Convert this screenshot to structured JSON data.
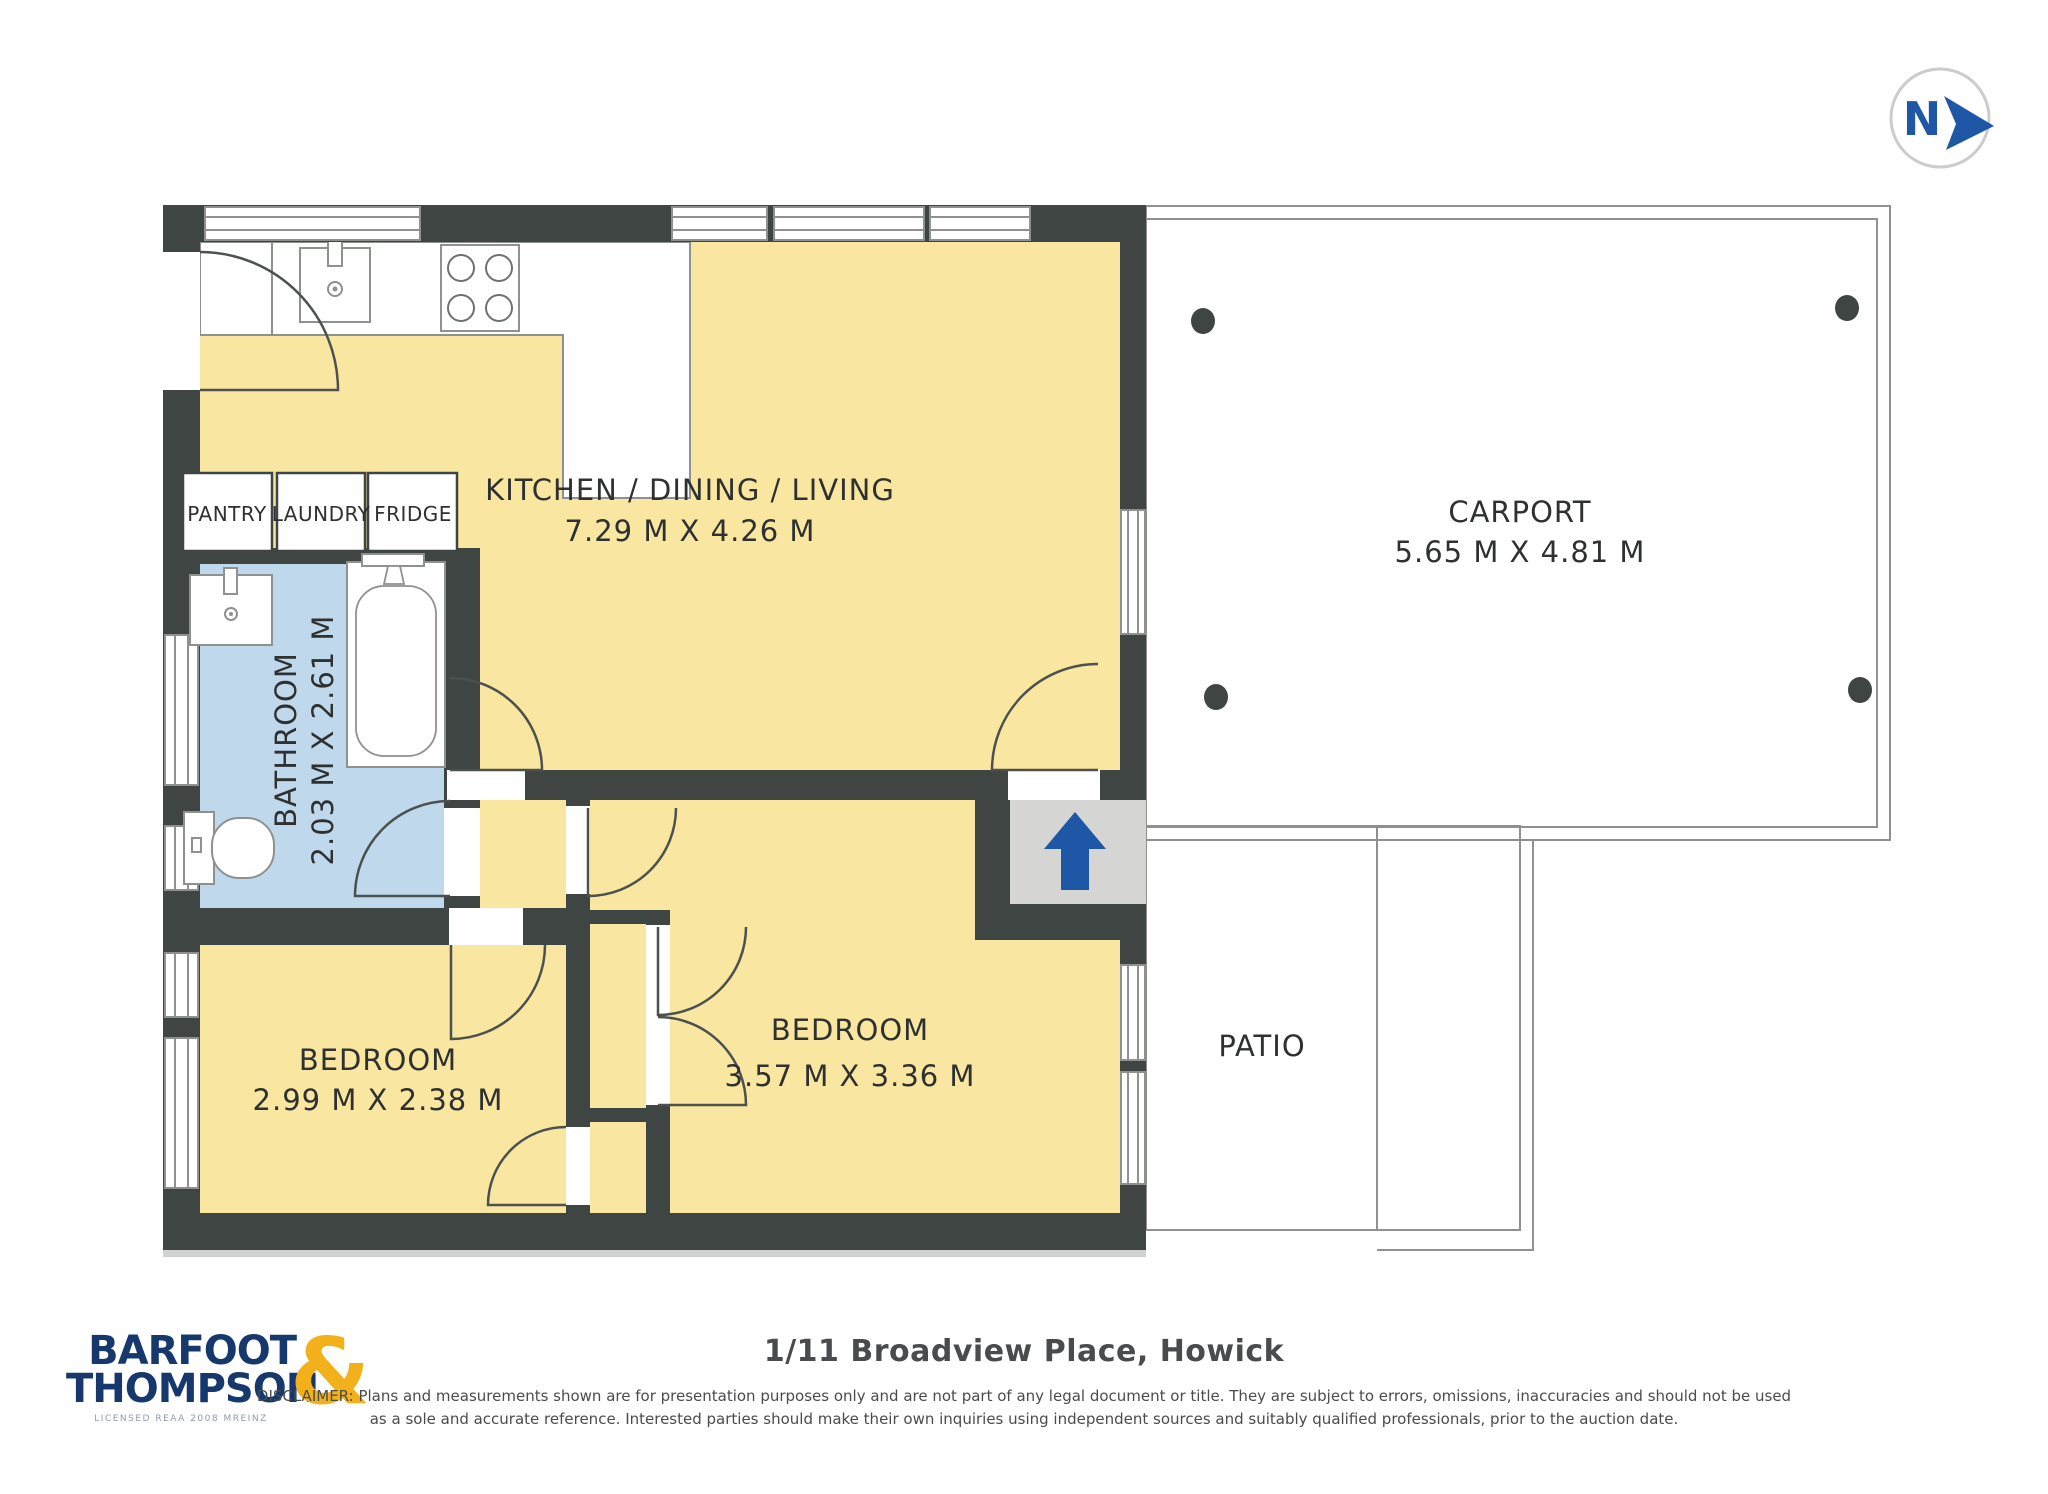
{
  "compass": {
    "label": "N"
  },
  "rooms": {
    "kitchen": {
      "name": "KITCHEN / DINING / LIVING",
      "dims": "7.29 M X 4.26 M"
    },
    "carport": {
      "name": "CARPORT",
      "dims": "5.65 M X 4.81 M"
    },
    "bathroom": {
      "name": "BATHROOM",
      "dims": "2.03 M X 2.61 M"
    },
    "bedroom1": {
      "name": "BEDROOM",
      "dims": "2.99 M X 2.38 M"
    },
    "bedroom2": {
      "name": "BEDROOM",
      "dims": "3.57 M X 3.36 M"
    },
    "patio": {
      "name": "PATIO"
    },
    "pantry": {
      "name": "PANTRY"
    },
    "laundry": {
      "name": "LAUNDRY"
    },
    "fridge": {
      "name": "FRIDGE"
    }
  },
  "footer": {
    "address": "1/11 Broadview Place, Howick",
    "disclaimer_line1": "DISCLAIMER: Plans and measurements shown are for presentation purposes only and are not part of any legal document or title. They are subject to errors, omissions, inaccuracies and should not be used",
    "disclaimer_line2": "as a sole and accurate reference. Interested parties should make their own inquiries using independent sources and suitably qualified professionals, prior to the auction date."
  },
  "logo": {
    "line1": "BARFOOT",
    "line2": "THOMPSON",
    "ampersand": "&",
    "tagline": "LICENSED REAA 2008 MREINZ"
  },
  "colors": {
    "wall": "#3E4543",
    "floor_yellow": "#F9E7A1",
    "bathroom_blue": "#BFD8EB",
    "hard_surface_gray": "#D5D6D4",
    "entry_arrow_blue": "#1E57A5",
    "logo_navy": "#16386D",
    "logo_gold": "#F2B11B"
  }
}
